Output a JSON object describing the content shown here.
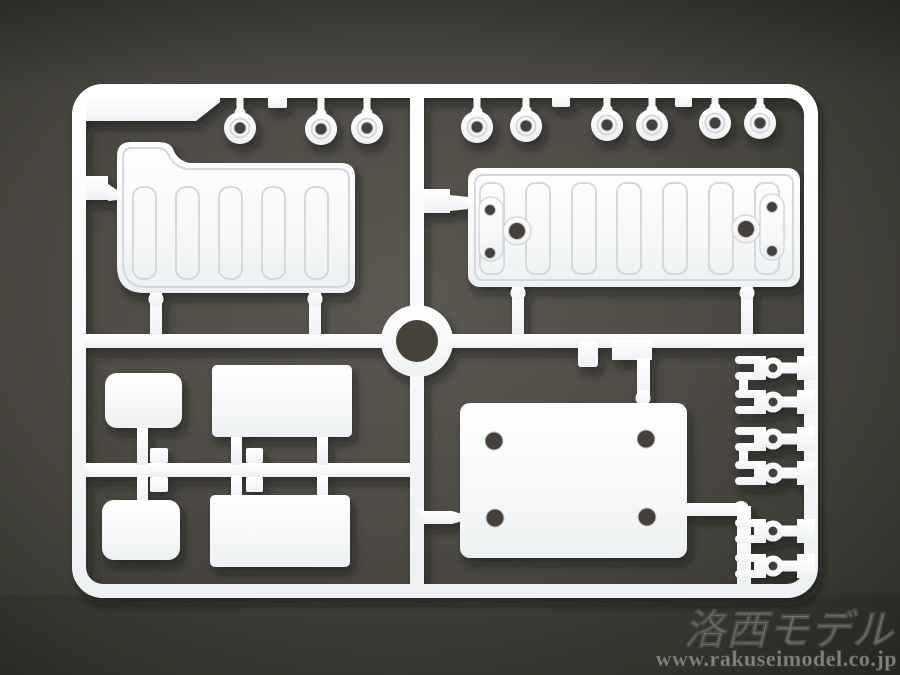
{
  "watermark": {
    "brand": "洛西モデル",
    "url": "www.rakuseimodel.co.jp"
  },
  "scene": {
    "description": "White injection-molded plastic model kit sprue (runner frame with parts) photographed on a dark gray surface",
    "colors": {
      "plastic": "#f4f5f7",
      "plastic_shadow_line": "#d5d8db",
      "background_center": "#57554d",
      "background_edge": "#2f2e29",
      "hole_dark": "#44413a",
      "watermark_text": "#8b8984"
    },
    "part_counts": {
      "small_ring_parts_top_left": 3,
      "small_ring_parts_top_right": 6,
      "ribbed_panel_parts": 2,
      "plain_plate_parts": 5,
      "fork_connector_parts": 6,
      "center_alignment_ring": 1
    }
  }
}
